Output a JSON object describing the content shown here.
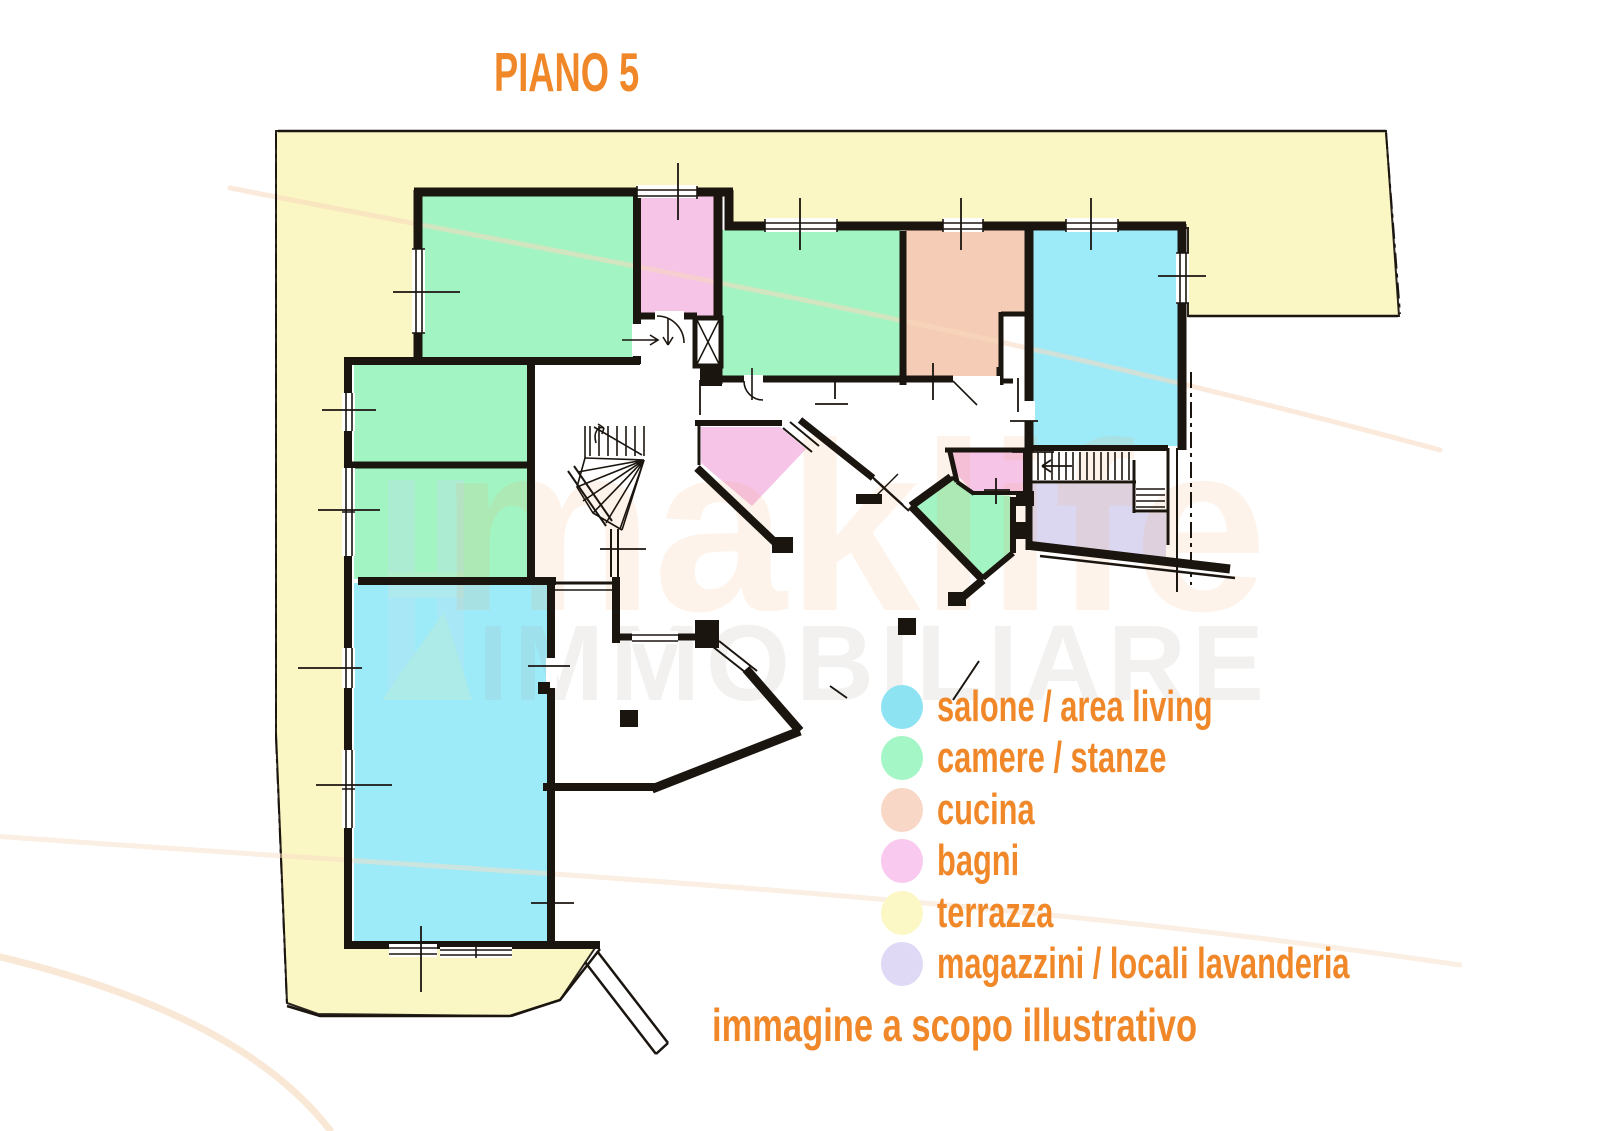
{
  "title": "PIANO 5",
  "caption": "immagine a scopo illustrativo",
  "watermark": {
    "brand": "maklife",
    "subtitle": "IMMOBILIARE"
  },
  "colors": {
    "salone": "#9debf9",
    "camere": "#a2f4c3",
    "cucina": "#f5cdb6",
    "bagni": "#f6c4e7",
    "terrazza": "#fbf7c4",
    "magazzini": "#dcd7f1",
    "wall": "#1b1510",
    "accent_orange": "#f0882a"
  },
  "legend": {
    "items": [
      {
        "key": "salone",
        "label": "salone / area living",
        "color": "#8ee3f3"
      },
      {
        "key": "camere",
        "label": "camere / stanze",
        "color": "#a5f6c7"
      },
      {
        "key": "cucina",
        "label": "cucina",
        "color": "#f9d7c6"
      },
      {
        "key": "bagni",
        "label": "bagni",
        "color": "#f9c9ef"
      },
      {
        "key": "terrazza",
        "label": "terrazza",
        "color": "#fcf8c6"
      },
      {
        "key": "magazzini",
        "label": "magazzini / locali lavanderia",
        "color": "#dfd9f5"
      }
    ]
  }
}
